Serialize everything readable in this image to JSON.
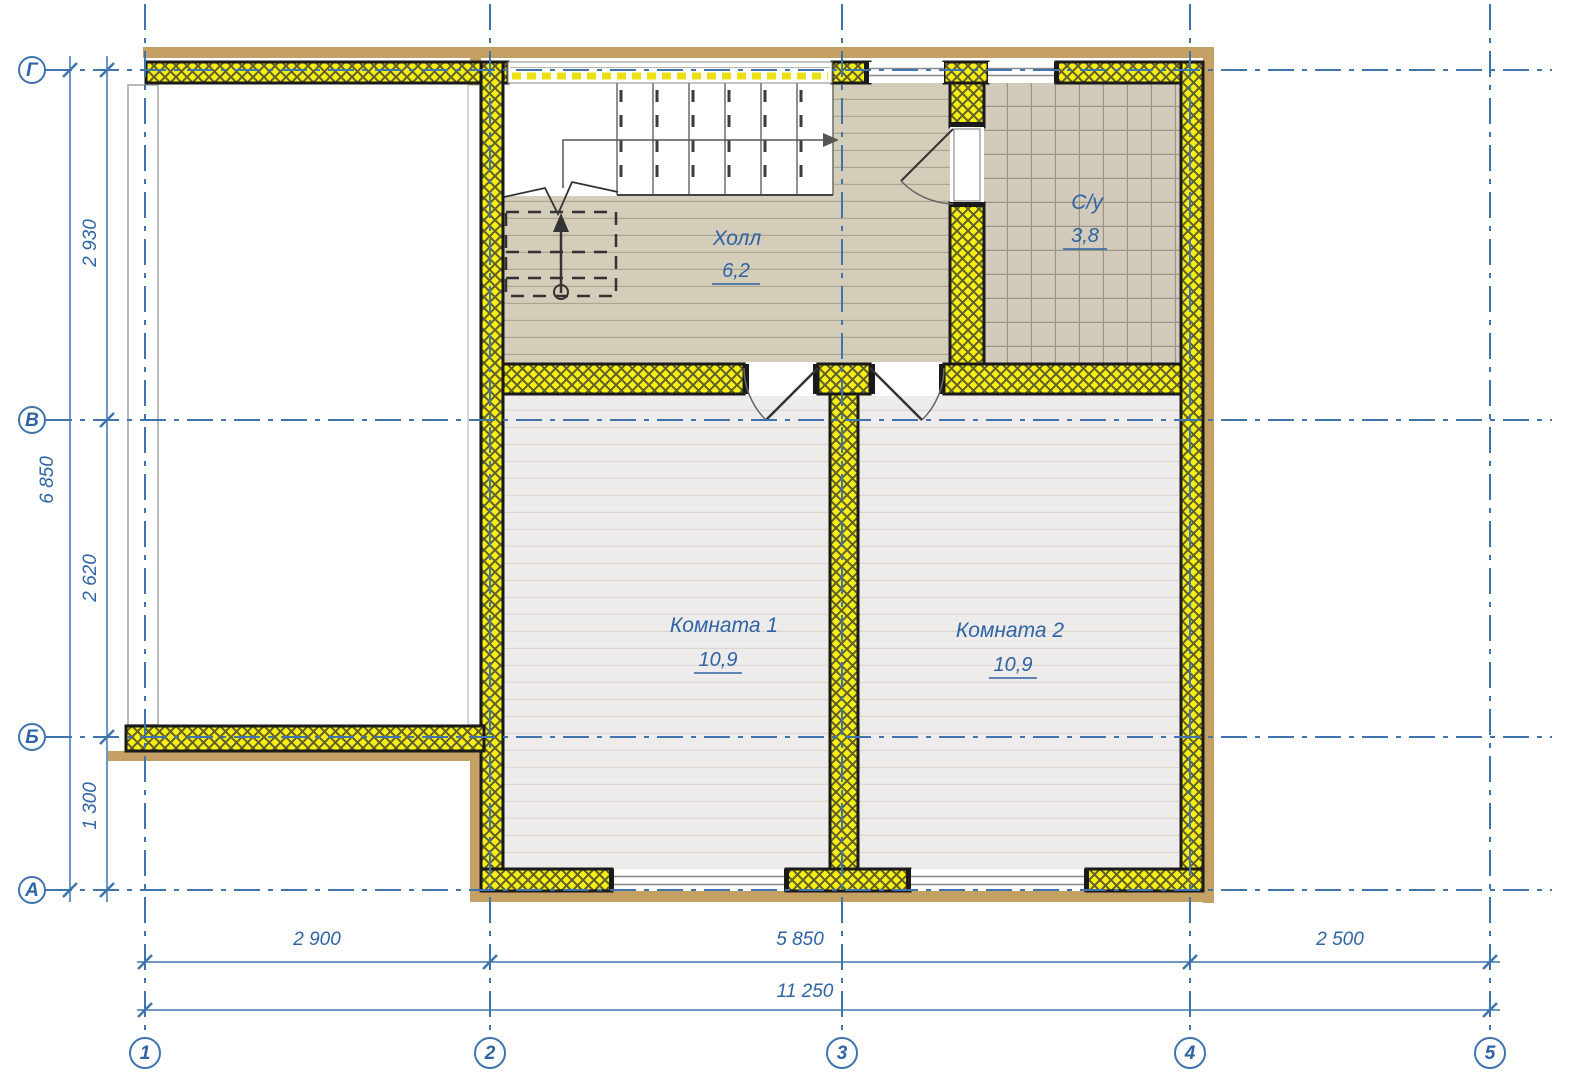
{
  "rooms": [
    {
      "name": "Холл",
      "area": "6,2"
    },
    {
      "name": "С/у",
      "area": "3,8"
    },
    {
      "name": "Комната 1",
      "area": "10,9"
    },
    {
      "name": "Комната 2",
      "area": "10,9"
    }
  ],
  "axis_rows": [
    "Г",
    "В",
    "Б",
    "А"
  ],
  "axis_cols": [
    "1",
    "2",
    "3",
    "4",
    "5"
  ],
  "dim_left": {
    "seg1": "2 930",
    "seg2": "2 620",
    "seg3": "1 300",
    "overall": "6 850"
  },
  "dim_bottom": {
    "seg1": "2 900",
    "seg2": "5 850",
    "seg3": "2 500",
    "overall": "11 250"
  },
  "colors": {
    "grid_blue": "#3F74AE",
    "label_blue": "#2E63A5",
    "insulation_yellow": "#F7EE12",
    "timber_tan": "#C5A065",
    "wall_black": "#1A1A1A",
    "hall_floor": "#D4CDBA",
    "tile_floor": "#D2CBBB",
    "room_floor": "#EDECEA"
  }
}
